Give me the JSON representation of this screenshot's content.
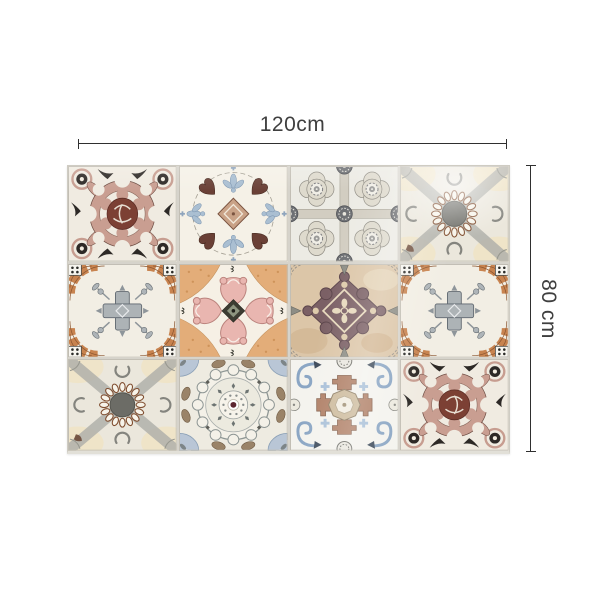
{
  "canvas": {
    "background": "#ffffff"
  },
  "dimensions": {
    "width": {
      "label": "120cm"
    },
    "height": {
      "label": "80 cm"
    },
    "line_color": "#2f2f2f",
    "label_color": "#3f3f3f"
  },
  "mural": {
    "name": "Moroccan patchwork tile sticker mural",
    "grid": {
      "rows": 3,
      "columns": 4
    },
    "tiles": [
      {
        "position": "row1-col1",
        "pattern": "pink rosette knot medallion with black corner dots",
        "colors": [
          "#c99e91",
          "#7c4034",
          "#2d2926",
          "#f0ebe1"
        ]
      },
      {
        "position": "row1-col2",
        "pattern": "blue leaf cross with brown hearts and tan center square",
        "colors": [
          "#aabfd2",
          "#6a4036",
          "#c9a287",
          "#f5f1e7"
        ]
      },
      {
        "position": "row1-col3",
        "pattern": "grey quatrefoil lattice with gear rosettes",
        "colors": [
          "#dedacd",
          "#8e8b82",
          "#6e7074",
          "#ecebe4"
        ]
      },
      {
        "position": "row1-col4",
        "pattern": "beaded ring medallion on grey diagonal cross",
        "colors": [
          "#b1b1ab",
          "#804e30",
          "#6c6c66",
          "#ebe7dc"
        ]
      },
      {
        "position": "row2-col1",
        "pattern": "terracotta corner arcs with grey central cross",
        "colors": [
          "#c8834f",
          "#adb3b6",
          "#2b2b28",
          "#f2eee4"
        ]
      },
      {
        "position": "row2-col2",
        "pattern": "pink acanthus quatrefoil with dark diamond center",
        "colors": [
          "#e9b6b0",
          "#e3ad79",
          "#3c3c32",
          "#f6f0e5"
        ]
      },
      {
        "position": "row2-col3",
        "pattern": "plum ornate diamond medallion on tan ground",
        "colors": [
          "#7b6065",
          "#dcc6a8",
          "#8d8d85",
          "#e7d9bd"
        ]
      },
      {
        "position": "row2-col4",
        "pattern": "terracotta corner arcs with grey central cross (mirrored)",
        "colors": [
          "#c8834f",
          "#adb3b6",
          "#2b2b28",
          "#f2eee4"
        ]
      },
      {
        "position": "row3-col1",
        "pattern": "beaded ring medallion on grey diagonal cross",
        "colors": [
          "#b1b1ab",
          "#804e30",
          "#6c6c66",
          "#ebe7dc"
        ]
      },
      {
        "position": "row3-col2",
        "pattern": "scalloped circular mandala with maroon center dot",
        "colors": [
          "#8e9694",
          "#5c2530",
          "#b9c6d6",
          "#9a8368"
        ]
      },
      {
        "position": "row3-col3",
        "pattern": "blue volute corners with stepped cross and octagon center",
        "colors": [
          "#8ba6c4",
          "#b08067",
          "#cdbb9d",
          "#f4f3ee"
        ]
      },
      {
        "position": "row3-col4",
        "pattern": "pink rosette knot medallion with black corner dots (mirrored)",
        "colors": [
          "#c99e91",
          "#7c4034",
          "#2d2926",
          "#f0ebe1"
        ]
      }
    ]
  }
}
